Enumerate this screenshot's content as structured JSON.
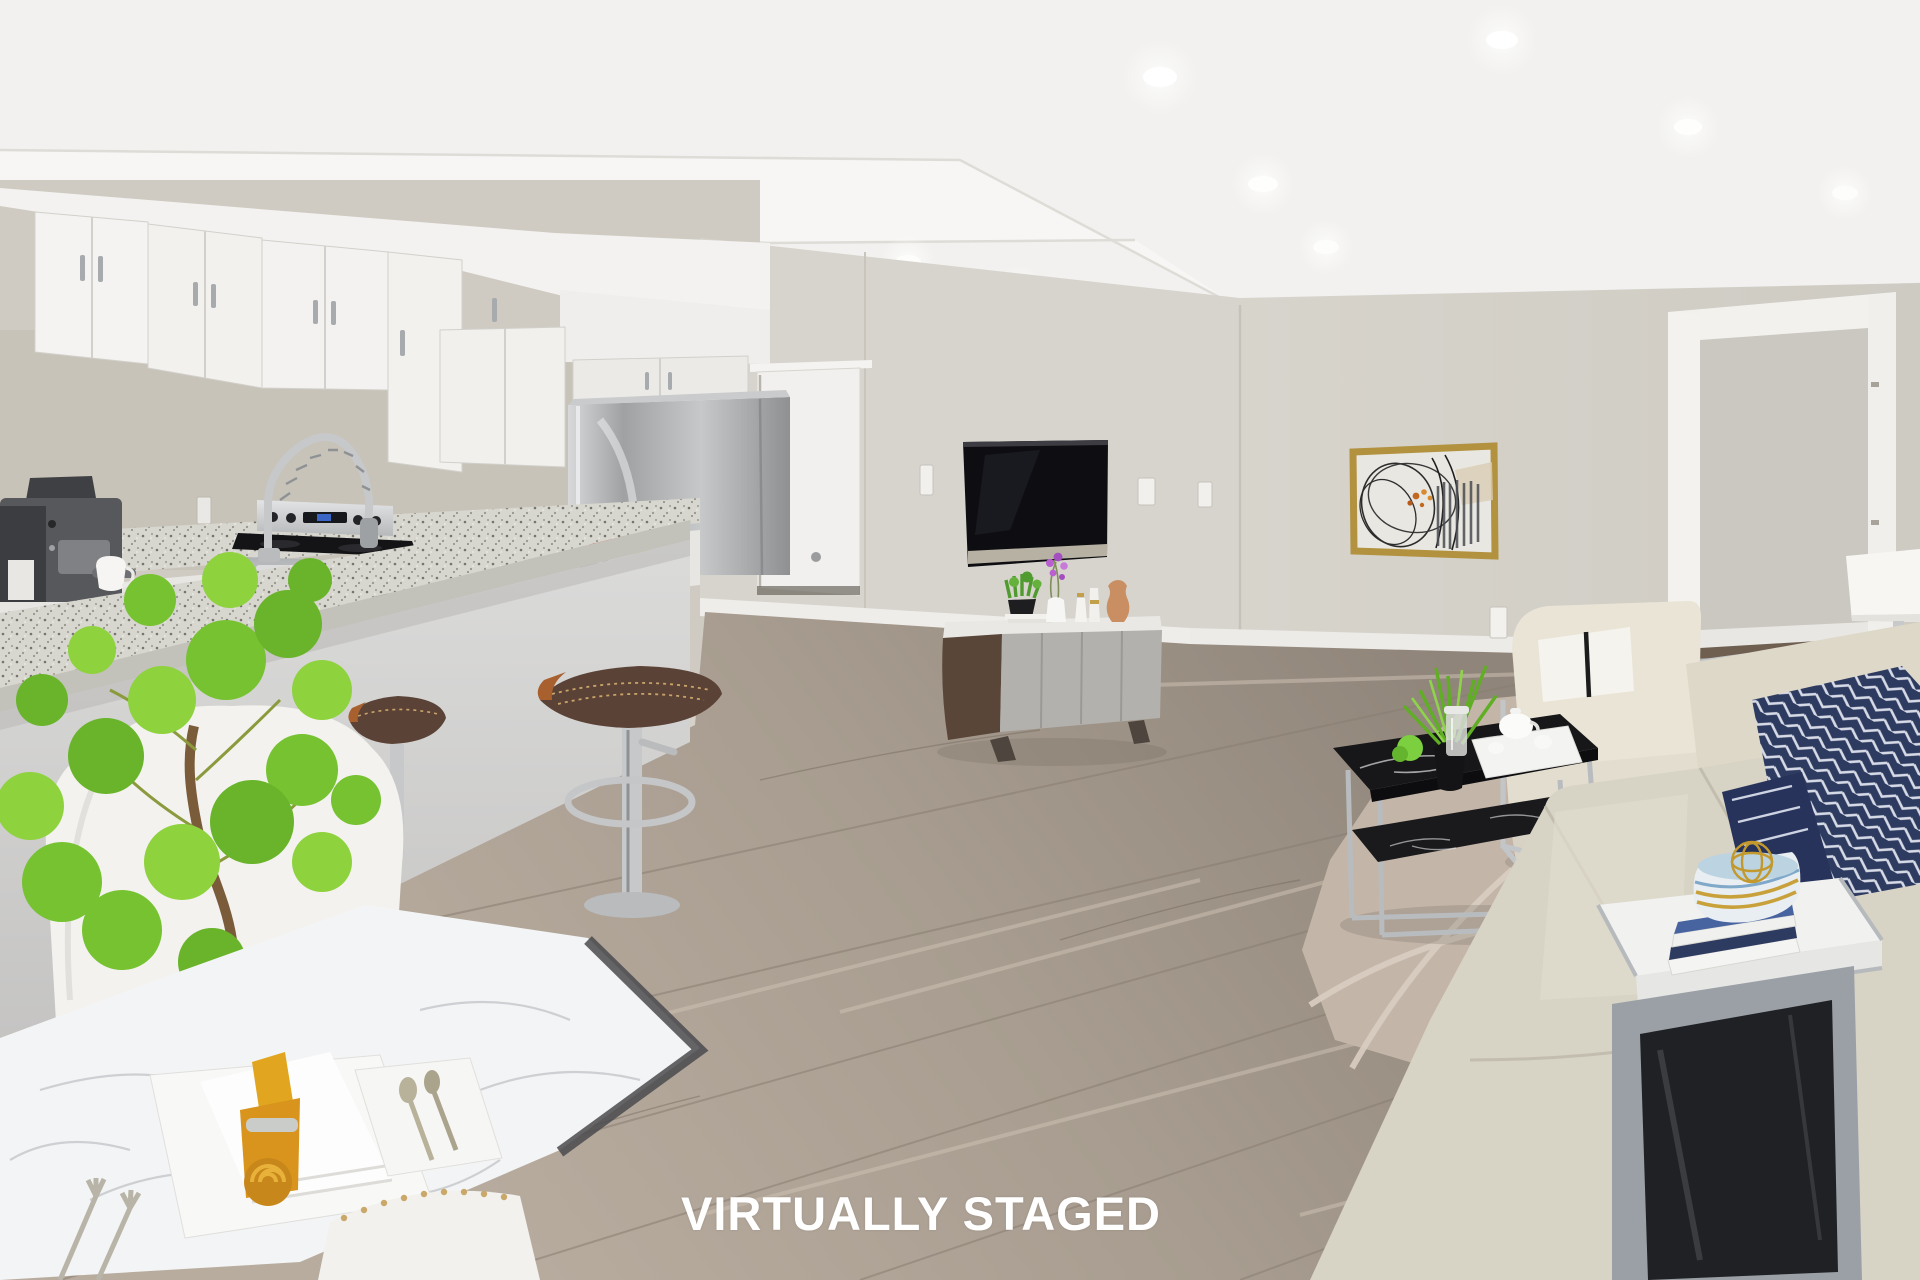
{
  "watermark": {
    "text": "VIRTUALLY STAGED",
    "color": "#ffffff"
  },
  "scene": {
    "description": "Virtually staged open-concept lower-level suite: white kitchen with granite breakfast bar on the left, marble dining nook in the foreground, living area with wall-mounted TV, media console, gold-framed abstract art, cream seating and a doorway to an adjacent room on the right",
    "rooms": [
      "kitchen",
      "dining nook",
      "living room",
      "adjacent room doorway"
    ],
    "palette": {
      "ceiling": "#f2f1ef",
      "wall_greige": "#d6d2ca",
      "backsplash": "#c8c3b8",
      "wood_floor": "#a3988c",
      "area_rug": "#c3b5a8",
      "rug_tan_band": "#dcc3ab",
      "cabinet_white": "#f2f1ee",
      "granite_counter": "#d7d6cf",
      "stainless_steel": "#b7b9ba",
      "range_black": "#141416",
      "tv_screen": "#0e0e12",
      "tv_trim_silver": "#b7b1a4",
      "console_walnut": "#5a4639",
      "console_gray": "#b3b1ae",
      "sofa_cream": "#d7d3c5",
      "pillow_navy": "#2e3b60",
      "coffee_table_black_marble": "#17171a",
      "chrome": "#b9bcbe",
      "art_frame_gold": "#b2913f",
      "napkin_yellow": "#e2a51f",
      "plant_green": "#7cc832",
      "stool_leather_brown": "#5b4236",
      "terracotta": "#c98f63",
      "orchid_purple": "#b95fd0",
      "doorway_dark_floor": "#6e5f51"
    },
    "objects": [
      "recessed ceiling lights",
      "white shaker upper cabinets",
      "espresso machine with white cup",
      "chrome spring gooseneck faucet",
      "stainless electric range",
      "stainless refrigerator",
      "fruit bowl with navy wave rim",
      "white interior door",
      "granite breakfast bar",
      "brown leather swivel bar stools",
      "white dining chairs",
      "white marble dining table",
      "potted pilea plant in white pot",
      "place setting with rolled yellow napkin and cutlery",
      "wall-mounted flat screen TV",
      "two-tone media console with decor vases and orchid",
      "light switches and outlet",
      "abstract art in gold frame",
      "cream armchair with chrome frame and striped pillow",
      "black marble two-tier coffee table with plant and tea tray",
      "beige area rug with circle line pattern",
      "beige sofa with navy geometric pillows",
      "white side table with book stack and striped bowl with gold orb",
      "white rectangular table lamp",
      "watermark caption"
    ]
  }
}
